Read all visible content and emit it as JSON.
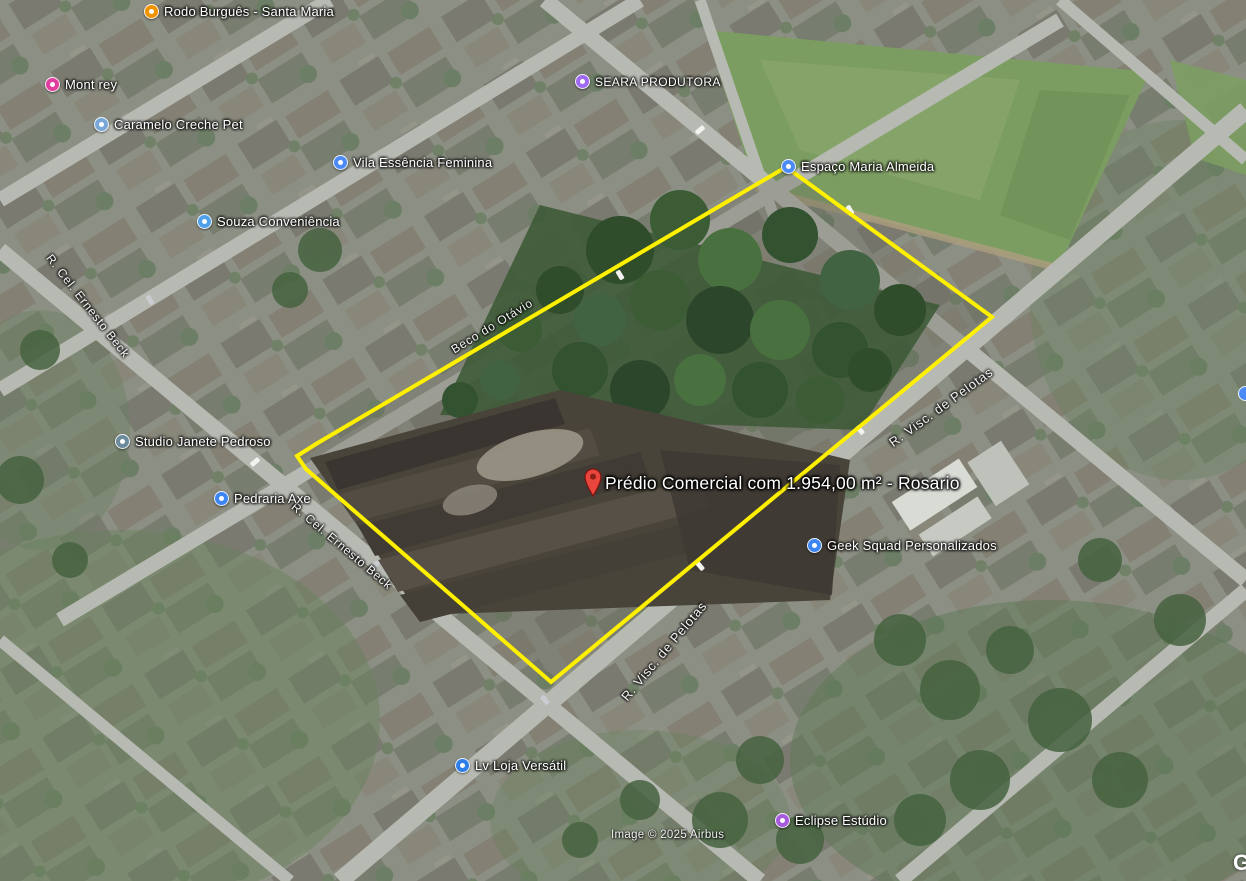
{
  "map": {
    "attribution": "Image © 2025 Airbus",
    "watermark": "G",
    "property": {
      "label": "Prédio Comercial com 1.954,00 m² - Rosario",
      "outline_color": "#FFF000",
      "pin_color": "#E8453C",
      "polygon_points": "786,167 992,317 551,682 306,469 297,456 316,444"
    },
    "pois": [
      {
        "name": "Rodo Burguês - Santa Maria",
        "icon": "restaurant",
        "color": "#F09300"
      },
      {
        "name": "Mont rey",
        "icon": "shopping",
        "color": "#E13D9E"
      },
      {
        "name": "Caramelo Creche Pet",
        "icon": "pet-care",
        "color": "#79A8D8"
      },
      {
        "name": "Vila Essência Feminina",
        "icon": "store",
        "color": "#4C8BF5"
      },
      {
        "name": "Souza Conveniência",
        "icon": "convenience-store",
        "color": "#4FA0E8"
      },
      {
        "name": "SEARA PRODUTORA",
        "icon": "business",
        "color": "#A06AF0"
      },
      {
        "name": "Espaço Maria Almeida",
        "icon": "event-venue",
        "color": "#4C8BF5"
      },
      {
        "name": "Studio Janete Pedroso",
        "icon": "studio",
        "color": "#6B8A9C"
      },
      {
        "name": "Pedraria Axe",
        "icon": "shopping-bag",
        "color": "#3D85F0"
      },
      {
        "name": "Geek Squad Personalizados",
        "icon": "shopping-bag",
        "color": "#3D85F0"
      },
      {
        "name": "Lv Loja Versátil",
        "icon": "shopping-bag",
        "color": "#2E7DE8"
      },
      {
        "name": "Eclipse Estúdio",
        "icon": "studio",
        "color": "#A65BDD"
      }
    ],
    "streets": [
      {
        "name": "Beco do Otávio"
      },
      {
        "name": "R. Visc. de Pelotas"
      },
      {
        "name": "R. Visc. de Pelotas"
      },
      {
        "name": "R. Cel. Ernesto Beck"
      },
      {
        "name": "R. Cel. Ernesto Beck"
      }
    ]
  }
}
